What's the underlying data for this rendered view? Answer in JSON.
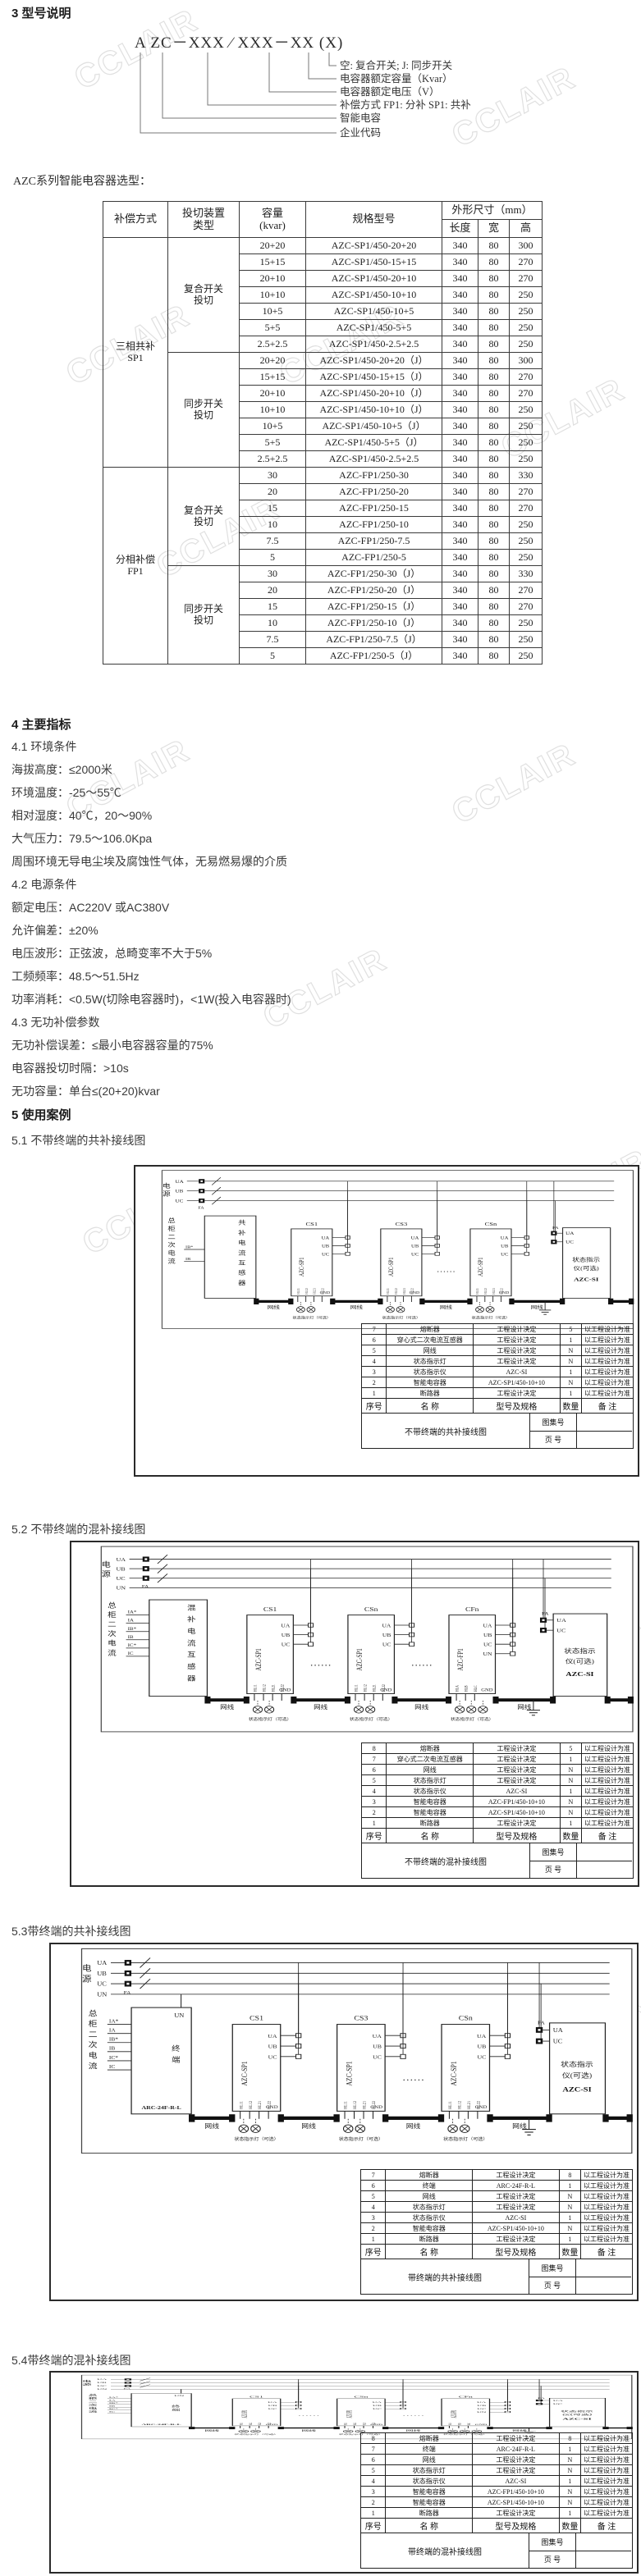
{
  "watermark": "CCLAIR",
  "section3": {
    "heading": "3 型号说明",
    "model": {
      "code": "A ZC－XXX ∕ XXX－XX (X)",
      "labels": [
        "空: 复合开关; J: 同步开关",
        "电容器额定容量（Kvar）",
        "电容器额定电压（V）",
        "补偿方式 FP1: 分补 SP1: 共补",
        "智能电容",
        "企业代码"
      ]
    }
  },
  "selection": {
    "intro": "AZC系列智能电容器选型：",
    "headers": {
      "mode": "补偿方式",
      "switch": "投切装置\n类型",
      "capacity": "容量\n(kvar)",
      "model": "规格型号",
      "dims": "外形尺寸（mm）",
      "len": "长度",
      "wid": "宽",
      "hei": "高"
    },
    "groups": [
      {
        "mode": "三相共补\nSP1",
        "subgroups": [
          {
            "switch": "复合开关\n投切",
            "rows": [
              [
                "20+20",
                "AZC-SP1/450-20+20",
                "340",
                "80",
                "300"
              ],
              [
                "15+15",
                "AZC-SP1/450-15+15",
                "340",
                "80",
                "270"
              ],
              [
                "20+10",
                "AZC-SP1/450-20+10",
                "340",
                "80",
                "270"
              ],
              [
                "10+10",
                "AZC-SP1/450-10+10",
                "340",
                "80",
                "250"
              ],
              [
                "10+5",
                "AZC-SP1/450-10+5",
                "340",
                "80",
                "250"
              ],
              [
                "5+5",
                "AZC-SP1/450-5+5",
                "340",
                "80",
                "250"
              ],
              [
                "2.5+2.5",
                "AZC-SP1/450-2.5+2.5",
                "340",
                "80",
                "250"
              ]
            ]
          },
          {
            "switch": "同步开关\n投切",
            "rows": [
              [
                "20+20",
                "AZC-SP1/450-20+20（J）",
                "340",
                "80",
                "300"
              ],
              [
                "15+15",
                "AZC-SP1/450-15+15（J）",
                "340",
                "80",
                "270"
              ],
              [
                "20+10",
                "AZC-SP1/450-20+10（J）",
                "340",
                "80",
                "270"
              ],
              [
                "10+10",
                "AZC-SP1/450-10+10（J）",
                "340",
                "80",
                "250"
              ],
              [
                "10+5",
                "AZC-SP1/450-10+5（J）",
                "340",
                "80",
                "250"
              ],
              [
                "5+5",
                "AZC-SP1/450-5+5（J）",
                "340",
                "80",
                "250"
              ],
              [
                "2.5+2.5",
                "AZC-SP1/450-2.5+2.5",
                "340",
                "80",
                "250"
              ]
            ]
          }
        ]
      },
      {
        "mode": "分相补偿\nFP1",
        "subgroups": [
          {
            "switch": "复合开关\n投切",
            "rows": [
              [
                "30",
                "AZC-FP1/250-30",
                "340",
                "80",
                "330"
              ],
              [
                "20",
                "AZC-FP1/250-20",
                "340",
                "80",
                "270"
              ],
              [
                "15",
                "AZC-FP1/250-15",
                "340",
                "80",
                "270"
              ],
              [
                "10",
                "AZC-FP1/250-10",
                "340",
                "80",
                "250"
              ],
              [
                "7.5",
                "AZC-FP1/250-7.5",
                "340",
                "80",
                "250"
              ],
              [
                "5",
                "AZC-FP1/250-5",
                "340",
                "80",
                "250"
              ]
            ]
          },
          {
            "switch": "同步开关\n投切",
            "rows": [
              [
                "30",
                "AZC-FP1/250-30（J）",
                "340",
                "80",
                "330"
              ],
              [
                "20",
                "AZC-FP1/250-20（J）",
                "340",
                "80",
                "270"
              ],
              [
                "15",
                "AZC-FP1/250-15（J）",
                "340",
                "80",
                "270"
              ],
              [
                "10",
                "AZC-FP1/250-10（J）",
                "340",
                "80",
                "250"
              ],
              [
                "7.5",
                "AZC-FP1/250-7.5（J）",
                "340",
                "80",
                "250"
              ],
              [
                "5",
                "AZC-FP1/250-5（J）",
                "340",
                "80",
                "250"
              ]
            ]
          }
        ]
      }
    ]
  },
  "section4": {
    "heading": "4 主要指标",
    "lines": [
      "4.1 环境条件",
      "海拔高度：≤2000米",
      "环境温度：-25～55℃",
      "相对湿度：40℃，20～90%",
      "大气压力：79.5～106.0Kpa",
      "周围环境无导电尘埃及腐蚀性气体，无易燃易爆的介质",
      "4.2 电源条件",
      "额定电压：AC220V 或AC380V",
      "允许偏差：±20%",
      "电压波形：正弦波，总畸变率不大于5%",
      "工频频率：48.5～51.5Hz",
      "功率消耗：<0.5W(切除电容器时)，<1W(投入电容器时)",
      "4.3 无功补偿参数",
      "无功补偿误差：≤最小电容器容量的75%",
      "电容器投切时隔：>10s",
      "无功容量：单台≤(20+20)kvar"
    ]
  },
  "section5": {
    "heading": "5 使用案例",
    "cases": [
      {
        "title": "5.1 不带终端的共补接线图",
        "diagram": {
          "power": "电源",
          "phases": [
            "UA",
            "UB",
            "UC"
          ],
          "fuse": "FA",
          "bus": "总柜二次电流",
          "left_box": {
            "kind": "ct",
            "label": "共补电流互感器",
            "pins": [
              "IB*",
              "IB"
            ]
          },
          "units": [
            {
              "id": "CS1",
              "model": "AZC-SP1",
              "terms": [
                "UA",
                "UB",
                "UC"
              ],
              "pins": [
                "HL11",
                "HL12",
                "HL21",
                "HL22"
              ],
              "lamps": 2
            },
            {
              "id": "CS3",
              "model": "AZC-SP1",
              "terms": [
                "UA",
                "UB",
                "UC"
              ],
              "pins": [
                "HL11",
                "HL12",
                "HL21",
                "HL22"
              ],
              "lamps": 2
            },
            {
              "id": "CSn",
              "model": "AZC-SP1",
              "terms": [
                "UA",
                "UB",
                "UC"
              ],
              "pins": [
                "HL11",
                "HL12",
                "HL21",
                "HL22"
              ],
              "lamps": 2
            }
          ],
          "dots": [
            1
          ],
          "cable": "网线",
          "gnd": "GND",
          "lamps_label": "状态指示灯（可选）",
          "indicator": {
            "name_lines": [
              "状态指示",
              "仪(可选)"
            ],
            "model": "AZC-SI",
            "inputs": [
              "UA",
              "UC"
            ],
            "fuse": "FA"
          }
        },
        "parts": {
          "headers": [
            "序号",
            "名  称",
            "型号及规格",
            "数量",
            "备  注"
          ],
          "rows": [
            [
              "7",
              "熔断器",
              "工程设计决定",
              "5",
              "以工程设计为准"
            ],
            [
              "6",
              "穿心式二次电流互感器",
              "工程设计决定",
              "1",
              "以工程设计为准"
            ],
            [
              "5",
              "网线",
              "工程设计决定",
              "N",
              "以工程设计为准"
            ],
            [
              "4",
              "状态指示灯",
              "工程设计决定",
              "N",
              "以工程设计为准"
            ],
            [
              "3",
              "状态指示仪",
              "AZC-SI",
              "1",
              "以工程设计为准"
            ],
            [
              "2",
              "智能电容器",
              "AZC-SP1/450-10+10",
              "N",
              "以工程设计为准"
            ],
            [
              "1",
              "断路器",
              "工程设计决定",
              "1",
              "以工程设计为准"
            ]
          ],
          "title": "不带终端的共补接线图",
          "atlas_label": "图集号",
          "page_label": "页  号",
          "atlas_value": "",
          "page_value": ""
        }
      },
      {
        "title": "5.2 不带终端的混补接线图",
        "diagram": {
          "power": "电源",
          "phases": [
            "UA",
            "UB",
            "UC",
            "UN"
          ],
          "fuse": "FA",
          "bus": "总柜二次电流",
          "left_box": {
            "kind": "ct",
            "label": "混补电流互感器",
            "pins": [
              "IA*",
              "IA",
              "IB*",
              "IB",
              "IC*",
              "IC"
            ]
          },
          "units": [
            {
              "id": "CS1",
              "model": "AZC-SP1",
              "terms": [
                "UA",
                "UB",
                "UC"
              ],
              "pins": [
                "HL11",
                "HL12",
                "HL21",
                "HL22"
              ],
              "lamps": 2
            },
            {
              "id": "CSn",
              "model": "AZC-SP1",
              "terms": [
                "UA",
                "UB",
                "UC"
              ],
              "pins": [
                "HL11",
                "HL12",
                "HL21",
                "HL22"
              ],
              "lamps": 2
            },
            {
              "id": "CFn",
              "model": "AZC-FP1",
              "terms": [
                "UA",
                "UB",
                "UC",
                "UN"
              ],
              "pins": [
                "HLA",
                "HLB",
                "HLC"
              ],
              "lamps": 3
            }
          ],
          "dots": [
            0,
            1
          ],
          "cable": "网线",
          "gnd": "GND",
          "lamps_label": "状态指示灯（可选）",
          "indicator": {
            "name_lines": [
              "状态指示",
              "仪(可选)"
            ],
            "model": "AZC-SI",
            "inputs": [
              "UA",
              "UC"
            ],
            "fuse": "FA"
          }
        },
        "parts": {
          "headers": [
            "序号",
            "名  称",
            "型号及规格",
            "数量",
            "备  注"
          ],
          "rows": [
            [
              "8",
              "熔断器",
              "工程设计决定",
              "5",
              "以工程设计为准"
            ],
            [
              "7",
              "穿心式二次电流互感器",
              "工程设计决定",
              "1",
              "以工程设计为准"
            ],
            [
              "6",
              "网线",
              "工程设计决定",
              "N",
              "以工程设计为准"
            ],
            [
              "5",
              "状态指示灯",
              "工程设计决定",
              "N",
              "以工程设计为准"
            ],
            [
              "4",
              "状态指示仪",
              "AZC-SI",
              "1",
              "以工程设计为准"
            ],
            [
              "3",
              "智能电容器",
              "AZC-FP1/450-10+10",
              "N",
              "以工程设计为准"
            ],
            [
              "2",
              "智能电容器",
              "AZC-SP1/450-10+10",
              "N",
              "以工程设计为准"
            ],
            [
              "1",
              "断路器",
              "工程设计决定",
              "1",
              "以工程设计为准"
            ]
          ],
          "title": "不带终端的混补接线图",
          "atlas_label": "图集号",
          "page_label": "页  号",
          "atlas_value": "",
          "page_value": ""
        }
      },
      {
        "title": "5.3带终端的共补接线图",
        "diagram": {
          "power": "电源",
          "phases": [
            "UA",
            "UB",
            "UC",
            "UN"
          ],
          "fuse": "FA",
          "bus": "总柜二次电流",
          "left_box": {
            "kind": "terminal",
            "label": "终端",
            "model": "ARC-24F-R-L",
            "pins": [
              "IA*",
              "IA",
              "IB*",
              "IB",
              "IC*",
              "IC"
            ],
            "un": "UN"
          },
          "units": [
            {
              "id": "CS1",
              "model": "AZC-SP1",
              "terms": [
                "UA",
                "UB",
                "UC"
              ],
              "pins": [
                "HL11",
                "HL12",
                "HL21",
                "HL22"
              ],
              "lamps": 2
            },
            {
              "id": "CS3",
              "model": "AZC-SP1",
              "terms": [
                "UA",
                "UB",
                "UC"
              ],
              "pins": [
                "HL11",
                "HL12",
                "HL21",
                "HL22"
              ],
              "lamps": 2
            },
            {
              "id": "CSn",
              "model": "AZC-SP1",
              "terms": [
                "UA",
                "UB",
                "UC"
              ],
              "pins": [
                "HL11",
                "HL12",
                "HL21",
                "HL22"
              ],
              "lamps": 2
            }
          ],
          "dots": [
            1
          ],
          "cable": "网线",
          "gnd": "GND",
          "lamps_label": "状态指示灯（可选）",
          "indicator": {
            "name_lines": [
              "状态指示",
              "仪(可选)"
            ],
            "model": "AZC-SI",
            "inputs": [
              "UA",
              "UC"
            ],
            "fuse": "FA"
          }
        },
        "parts": {
          "headers": [
            "序号",
            "名  称",
            "型号及规格",
            "数量",
            "备  注"
          ],
          "rows": [
            [
              "7",
              "熔断器",
              "工程设计决定",
              "8",
              "以工程设计为准"
            ],
            [
              "6",
              "终端",
              "ARC-24F-R-L",
              "1",
              "以工程设计为准"
            ],
            [
              "5",
              "网线",
              "工程设计决定",
              "N",
              "以工程设计为准"
            ],
            [
              "4",
              "状态指示灯",
              "工程设计决定",
              "N",
              "以工程设计为准"
            ],
            [
              "3",
              "状态指示仪",
              "AZC-SI",
              "1",
              "以工程设计为准"
            ],
            [
              "2",
              "智能电容器",
              "AZC-SP1/450-10+10",
              "N",
              "以工程设计为准"
            ],
            [
              "1",
              "断路器",
              "工程设计决定",
              "1",
              "以工程设计为准"
            ]
          ],
          "title": "带终端的共补接线图",
          "atlas_label": "图集号",
          "page_label": "页  号",
          "atlas_value": "",
          "page_value": ""
        }
      },
      {
        "title": "5.4带终端的混补接线图",
        "diagram": {
          "power": "电源",
          "phases": [
            "UA",
            "UB",
            "UC",
            "UN"
          ],
          "fuse": "FA",
          "bus": "总柜二次电流",
          "left_box": {
            "kind": "terminal",
            "label": "终端",
            "model": "ARC-24F-R-L",
            "pins": [
              "IA*",
              "IA",
              "IB*",
              "IB",
              "IC*",
              "IC"
            ],
            "un": "UN"
          },
          "units": [
            {
              "id": "CS1",
              "model": "AZC-SP1",
              "terms": [
                "UA",
                "UB",
                "UC"
              ],
              "pins": [
                "HL11",
                "HL12",
                "HL21",
                "HL22"
              ],
              "lamps": 2
            },
            {
              "id": "CSn",
              "model": "AZC-SP1",
              "terms": [
                "UA",
                "UB",
                "UC"
              ],
              "pins": [
                "HL11",
                "HL12",
                "HL21",
                "HL22"
              ],
              "lamps": 2
            },
            {
              "id": "CFn",
              "model": "AZC-FP1",
              "terms": [
                "UA",
                "UB",
                "UC",
                "UN"
              ],
              "pins": [
                "HLA",
                "HLB",
                "HLC"
              ],
              "lamps": 3
            }
          ],
          "dots": [
            0,
            1
          ],
          "cable": "网线",
          "gnd": "GND",
          "lamps_label": "状态指示灯（可选）",
          "indicator": {
            "name_lines": [
              "状态指示",
              "仪(可选)"
            ],
            "model": "AZC-SI",
            "inputs": [
              "UA",
              "UC"
            ],
            "fuse": "FA"
          }
        },
        "parts": {
          "headers": [
            "序号",
            "名  称",
            "型号及规格",
            "数量",
            "备  注"
          ],
          "rows": [
            [
              "8",
              "熔断器",
              "工程设计决定",
              "8",
              "以工程设计为准"
            ],
            [
              "7",
              "终端",
              "ARC-24F-R-L",
              "1",
              "以工程设计为准"
            ],
            [
              "6",
              "网线",
              "工程设计决定",
              "N",
              "以工程设计为准"
            ],
            [
              "5",
              "状态指示灯",
              "工程设计决定",
              "N",
              "以工程设计为准"
            ],
            [
              "4",
              "状态指示仪",
              "AZC-SI",
              "1",
              "以工程设计为准"
            ],
            [
              "3",
              "智能电容器",
              "AZC-FP1/450-10+10",
              "N",
              "以工程设计为准"
            ],
            [
              "2",
              "智能电容器",
              "AZC-SP1/450-10+10",
              "N",
              "以工程设计为准"
            ],
            [
              "1",
              "断路器",
              "工程设计决定",
              "1",
              "以工程设计为准"
            ]
          ],
          "title": "带终端的混补接线图",
          "atlas_label": "图集号",
          "page_label": "页  号",
          "atlas_value": "",
          "page_value": ""
        }
      }
    ]
  }
}
